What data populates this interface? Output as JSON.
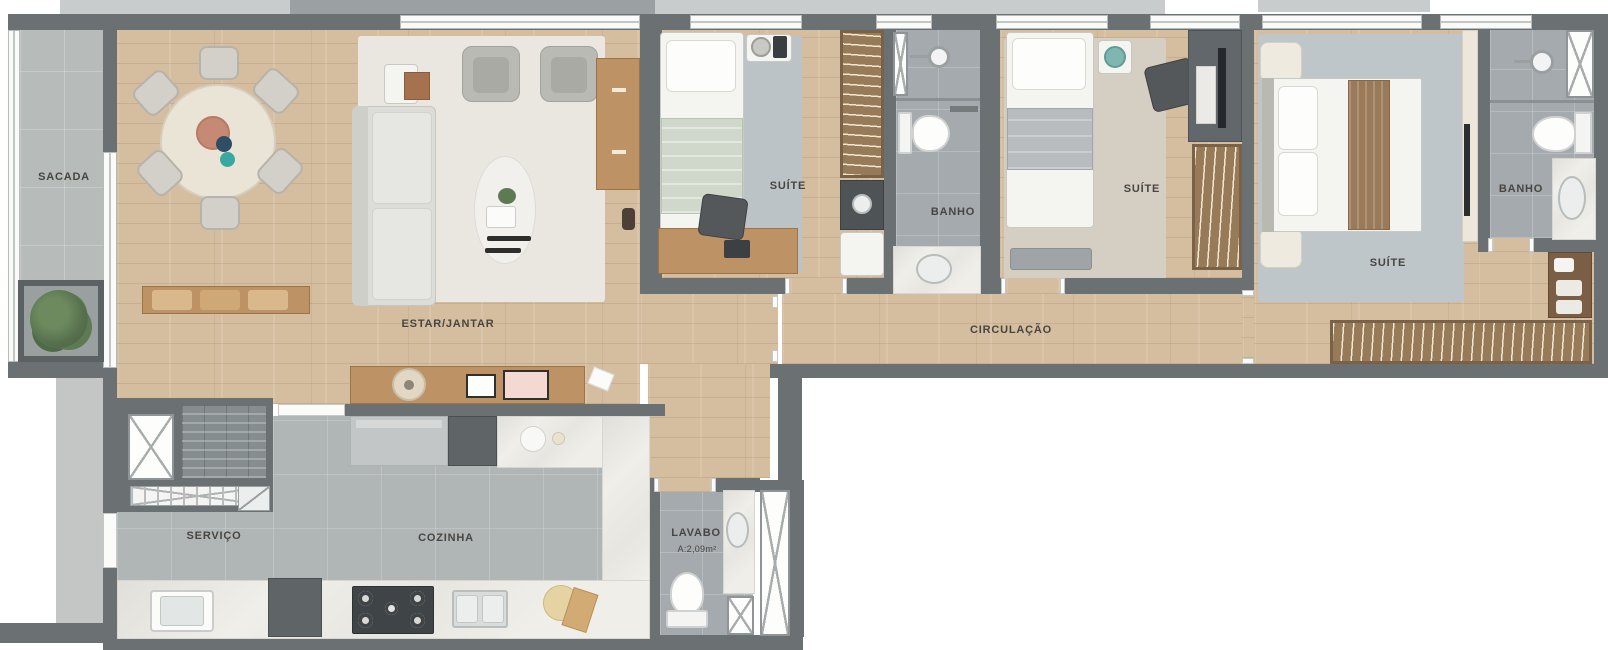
{
  "rooms": {
    "sacada": {
      "label": "SACADA"
    },
    "estar_jantar": {
      "label": "ESTAR/JANTAR"
    },
    "servico": {
      "label": "SERVIÇO"
    },
    "cozinha": {
      "label": "COZINHA"
    },
    "lavabo": {
      "label": "LAVABO",
      "area": "A:2,09m²"
    },
    "suite1": {
      "label": "SUÍTE"
    },
    "banho1": {
      "label": "BANHO"
    },
    "suite2": {
      "label": "SUÍTE"
    },
    "circulacao": {
      "label": "CIRCULAÇÃO"
    },
    "suite_master": {
      "label": "SUÍTE"
    },
    "banho_master": {
      "label": "BANHO"
    }
  },
  "colors": {
    "wall": "#6b7172",
    "wood_floor": "#d5bd9f",
    "bath_tile": "#a4aaad",
    "kitchen_tile": "#b0b5b6",
    "balcony_tile": "#b7bbba",
    "marble_counter": "#f0eee9",
    "rug_blue_gray": "#bcc3c6",
    "rug_beige": "#d5cec2",
    "rug_ivory": "#eae7e1",
    "label_text": "#474641"
  }
}
